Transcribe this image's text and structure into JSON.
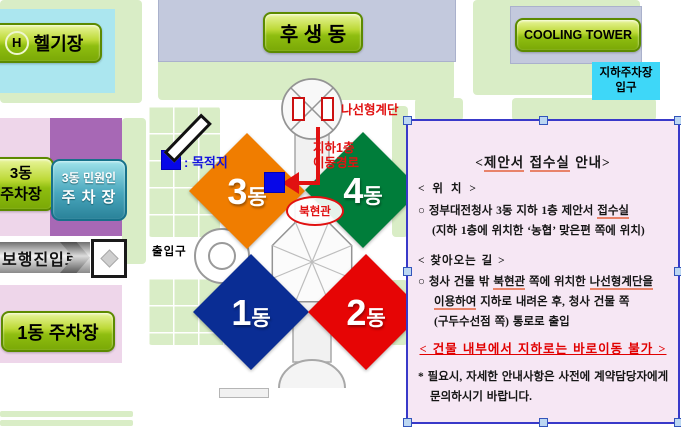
{
  "map": {
    "helipad": {
      "h": "H",
      "label": "헬기장"
    },
    "husaeng_label": "후 생 동",
    "cooling_label": "COOLING TOWER",
    "underground_parking": {
      "line1": "지하주차장",
      "line2": "입구"
    },
    "spiral_label": "나선형계단",
    "route": {
      "line1": "지하1층",
      "line2": "이동경로"
    },
    "legend_destination": ": 목적지",
    "north_gate": "북현관",
    "gate_label": "출입구",
    "ped_road": "보행진입로",
    "parking3": {
      "line1": "3동",
      "line2": "주차장"
    },
    "parking3_minwon": {
      "line1": "3동 민원인",
      "line2": "주 차 장"
    },
    "parking1": "1동 주차장",
    "b3": {
      "num": "3",
      "suf": "동"
    },
    "b4": {
      "num": "4",
      "suf": "동"
    },
    "b1": {
      "num": "1",
      "suf": "동"
    },
    "b2": {
      "num": "2",
      "suf": "동"
    }
  },
  "infobox": {
    "title": {
      "pre": "<",
      "u1": "제안서",
      "mid": " ",
      "u2": "접수실",
      "post": " 안내>"
    },
    "loc_header": "< 위 치 >",
    "loc1": {
      "pre": "○ 정부대전청사 3동 지하 1층 제안서 ",
      "u1": "접수실"
    },
    "loc2": "(지하 1층에 위치한 ‘농협’ 맞은편 쪽에 위치)",
    "dir_header": "< 찾아오는 길 >",
    "dir1": {
      "pre": "○ 청사 건물 밖 ",
      "u1": "북현관",
      "mid": " 쪽에 위치한 ",
      "u2": "나선형계단을"
    },
    "dir2": {
      "u1": "이용하여",
      "post": " 지하로 내려온 후, 청사 건물 쪽"
    },
    "dir3": "(구두수선점 쪽) 통로로 출입",
    "warning": "< 건물 내부에서 지하로는 바로이동 불가 >",
    "note1": "* 필요시, 자세한 안내사항은 사전에 계약담당자에게",
    "note2": "문의하시기 바랍니다."
  },
  "colors": {
    "building3": "#f07d00",
    "building4": "#007d3a",
    "building1": "#0a2d94",
    "building2": "#e60505",
    "destination_blue": "#0707e8",
    "route_red": "#e11111",
    "infobox_border": "#3939c9",
    "infobox_bg": "#f6e7f4",
    "label_green": "#8fbe10",
    "helipad_cyan": "#abe6ef",
    "parking_pink": "#eed6ea",
    "parking_purple": "#a768b5"
  }
}
